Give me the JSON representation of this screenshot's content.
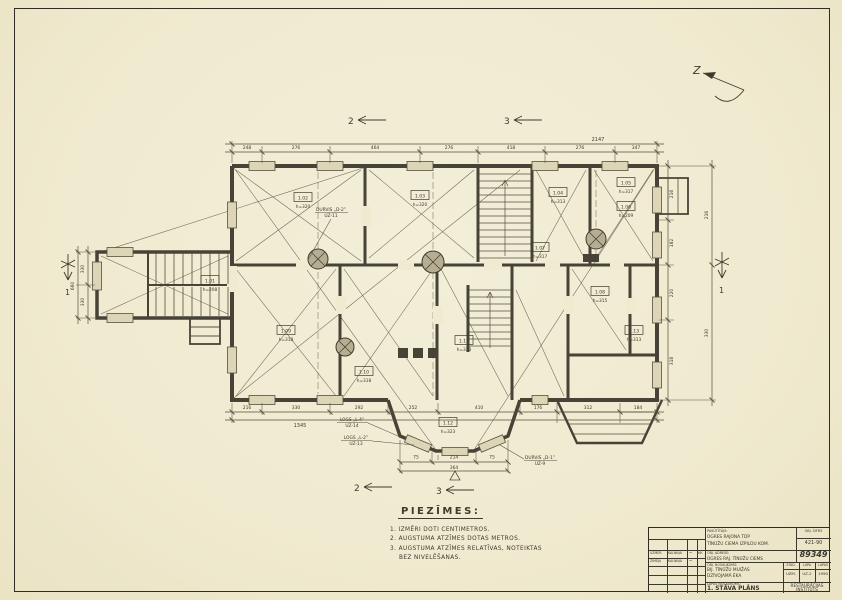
{
  "sheet": {
    "bg": "#f0ead0",
    "ink": "#3b382e"
  },
  "north": {
    "label": "Z"
  },
  "section_markers": {
    "top_left": "2",
    "top_right": "3",
    "bottom_left": "2",
    "bottom_right": "3",
    "side_left": "1",
    "side_right": "1"
  },
  "plan_labels": {
    "door_d2": "DURVIS „D-2”",
    "door_d2_ref": "UZ-11",
    "logs_l4": "LOGS „L-4”",
    "logs_l4_ref": "UZ-14",
    "logs_l2": "LOGS „L-2”",
    "logs_l2_ref": "UZ-13",
    "door_d1": "DURVIS „D-1”",
    "door_d1_ref": "UZ-9"
  },
  "rooms": [
    {
      "id": "1.01",
      "h": "h=208"
    },
    {
      "id": "1.02",
      "h": "h=320"
    },
    {
      "id": "1.03",
      "h": "h=320"
    },
    {
      "id": "1.04",
      "h": "h=313"
    },
    {
      "id": "1.05",
      "h": "h=317"
    },
    {
      "id": "1.06",
      "h": "h=209"
    },
    {
      "id": "1.07",
      "h": "h=317"
    },
    {
      "id": "1.08",
      "h": "h=315"
    },
    {
      "id": "1.09",
      "h": "h=318"
    },
    {
      "id": "1.10",
      "h": "h=318"
    },
    {
      "id": "1.11",
      "h": "h=323"
    },
    {
      "id": "1.12",
      "h": "h=323"
    },
    {
      "id": "1.13",
      "h": "h=313"
    }
  ],
  "dims": {
    "top": [
      "248",
      "276",
      "464",
      "276",
      "418",
      "276",
      "347"
    ],
    "top_total": "2147",
    "bottom": [
      "216",
      "330",
      "292",
      "252",
      "410",
      "176",
      "312",
      "184"
    ],
    "bottom_total": "1345",
    "bay": [
      "75",
      "214",
      "75"
    ],
    "bay_total": "364",
    "left": [
      "330",
      "330"
    ],
    "left_total": "660",
    "right": [
      "216",
      "182",
      "220",
      "318"
    ],
    "far_right": [
      "216",
      "330"
    ]
  },
  "notes": {
    "heading": "PIEZĪMES:",
    "items": [
      "1. IZMĒRI DOTI CENTIMETROS.",
      "2. AUGSTUMA ATZĪMES DOTAS METROS.",
      "3. AUGSTUMA ATZĪMES RELATĪVAS, NOTEIKTAS",
      "    BEZ NIVELĒŠANAS."
    ]
  },
  "title_block": {
    "client_label": "PASŪTĪTĀJS:",
    "client_line1": "OGRES RAJONA TDP",
    "client_line2": "TĪNŪŽU CIEMA IZPILDU KOM.",
    "code_label": "OBJ. ŠIFRS",
    "code": "421-90",
    "address_label": "OBJ. ADRESE:",
    "address": "OGRES RAJ. TĪNŪŽU CIEMS",
    "arch_no": "89349",
    "object_label": "OBJ. NOSAUKUMS:",
    "object_line1": "BIJ. TĪNŪŽU MUIŽAS",
    "object_line2": "DZĪVOJAMĀ ĒKA",
    "stage_label": "STAD.",
    "sheet_label": "LAPA",
    "sheets_label": "LAPAS",
    "stage": "UZM.",
    "sheet_no": "UZ-2",
    "sheets": "1990",
    "drawing_label": "LAPAS NOSAUKUMS:",
    "drawing_title": "1. STĀVA PLĀNS",
    "org_line1": "RESTAURĀCIJAS",
    "org_line2": "INSTITŪTS",
    "sig_rows": [
      {
        "role": "UZMĒR.",
        "name": "KALNIŅA",
        "sig": "~",
        "date": "HK"
      },
      {
        "role": "ZĪMĒJA",
        "name": "KALNIŅA",
        "sig": "~",
        "date": ""
      }
    ]
  }
}
